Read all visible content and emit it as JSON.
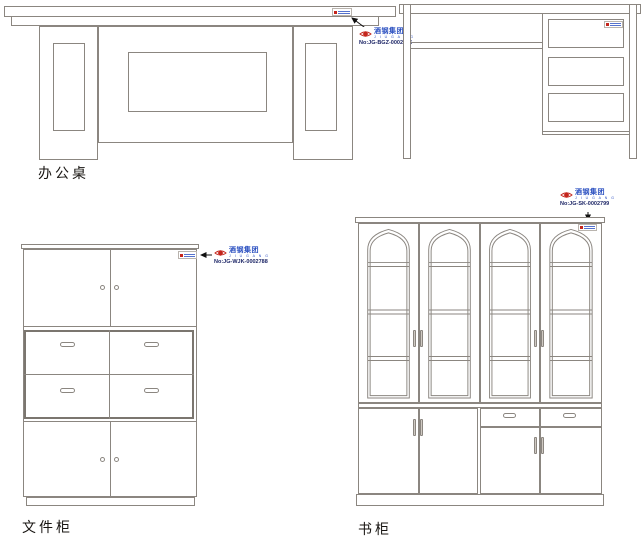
{
  "colors": {
    "line": "#8b8680",
    "line_dark": "#7b766f",
    "brand_blue": "#2a4fc0",
    "brand_red": "#c4251c",
    "number_text": "#1c2566",
    "caption_text": "#181512",
    "arrow": "#111111"
  },
  "figures": {
    "desk_front": {
      "caption": "办公桌",
      "label": {
        "brand_cn": "酒钢集团",
        "brand_en": "J I U G A N G",
        "number": "No:JG-BGZ-0002245"
      }
    },
    "file_cabinet": {
      "caption": "文件柜",
      "label": {
        "brand_cn": "酒钢集团",
        "brand_en": "J I U G A N G",
        "number": "No:JG-WJK-0002788"
      }
    },
    "bookcase": {
      "caption": "书柜",
      "label": {
        "brand_cn": "酒钢集团",
        "brand_en": "J I U G A N G",
        "number": "No:JG-SK-0002799"
      }
    }
  }
}
